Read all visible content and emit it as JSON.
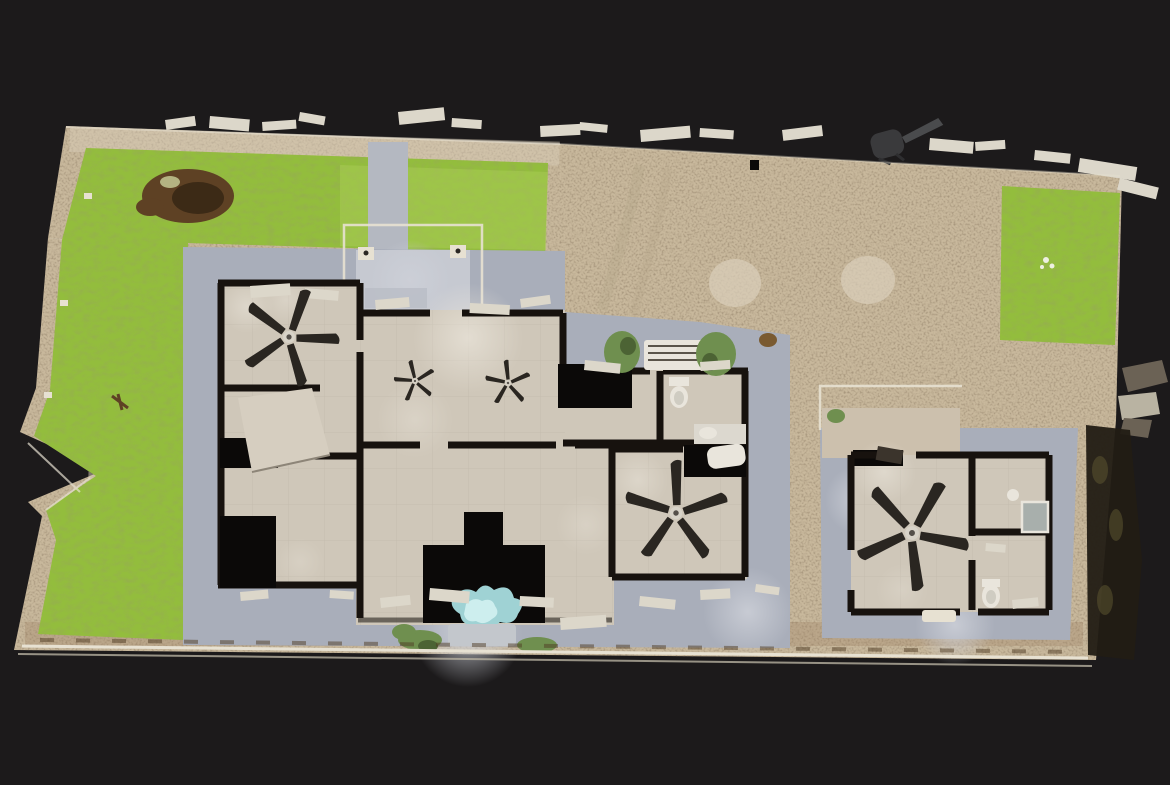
{
  "meta": {
    "view_type": "3d-scan-top-down-dollhouse-floorplan",
    "description": "Top-down orthographic view of a photogrammetry scan: roofless hurricane-damaged single-family property with main house, empty pool pit with water puddle, detached guest house, lawns, gravel yard, perimeter fence line and storm debris",
    "visible_text": "none"
  },
  "colors": {
    "background": "#1c1a1b",
    "gravel": "#c8b89c",
    "gravel_light": "#dacfbb",
    "dirt_patch": "#5e4124",
    "dirt_patch_dark": "#3c2a16",
    "dirt_line": "#4f3b24",
    "grass": "#93bd3d",
    "grass_light": "#aecf58",
    "walkway": "#b4b8c1",
    "apron": "#a9aeba",
    "apron_light": "#cdd0d8",
    "porch_slab": "#c6c9d1",
    "patio_tan": "#ccc0ad",
    "floor": "#cfc7b9",
    "floor_light": "#ece7dd",
    "wall": "#17120e",
    "void": "#0b0908",
    "water": "#9fd2d4",
    "water_light": "#cdeeee",
    "fence": "#e7e1d2",
    "debris_light": "#dcd7ca",
    "debris_dark": "#6b6255",
    "fan_blade": "#2a2621",
    "fan_hub": "#d8d3c8",
    "plant": "#6f8f4f",
    "plant_dark": "#4c6334",
    "vegetation_dark": "#221c14",
    "fixture": "#e9e5dc",
    "metal": "#a8afac",
    "grill": "#3a3a3c",
    "track": "#b2a488"
  },
  "scene": {
    "canvas": {
      "width": 1170,
      "height": 785
    },
    "ceiling_fans": [
      {
        "id": "living-room-ceiling-fan",
        "x": 289,
        "y": 337,
        "scale": 1.0,
        "rotate": 8
      },
      {
        "id": "great-room-fallen-fan-1",
        "x": 415,
        "y": 381,
        "scale": 0.42,
        "rotate": -25
      },
      {
        "id": "great-room-fallen-fan-2",
        "x": 508,
        "y": 383,
        "scale": 0.46,
        "rotate": 55
      },
      {
        "id": "family-room-ceiling-fan",
        "x": 676,
        "y": 513,
        "scale": 1.05,
        "rotate": -12
      },
      {
        "id": "guest-house-ceiling-fan",
        "x": 912,
        "y": 533,
        "scale": 1.15,
        "rotate": 18
      }
    ],
    "features": [
      "gravel yard",
      "front lawn",
      "left lawn strip",
      "right lawn patch",
      "bare dirt patch",
      "concrete walkway",
      "front porch frame posts",
      "main house without roof",
      "great room",
      "empty pool pit",
      "pool water puddle",
      "bathroom fixtures",
      "detached guest house",
      "guest bathroom with toilet and shower pan",
      "five ceiling fans",
      "storm debris along street edge",
      "overturned grill",
      "downed dark vegetation",
      "white perimeter fence line"
    ]
  }
}
